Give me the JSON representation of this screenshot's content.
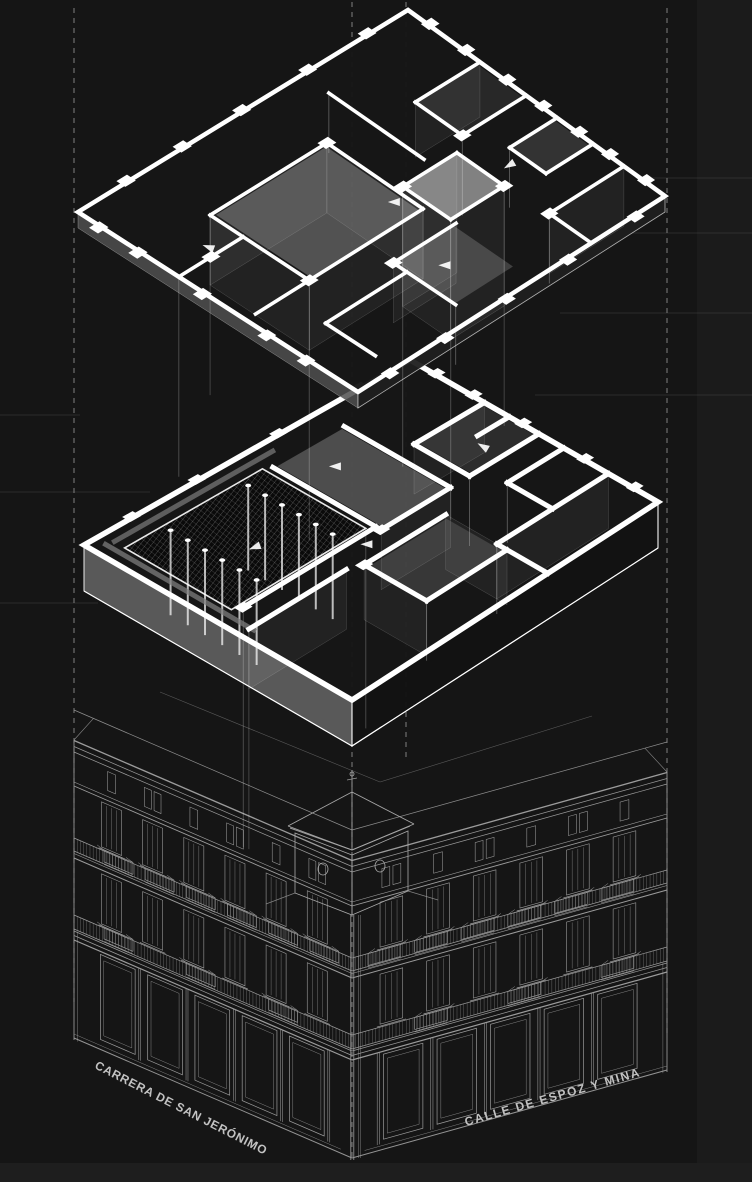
{
  "diagram": {
    "kind": "exploded-axonometric-architecture-drawing",
    "labels": {
      "street_left": "CARRERA DE SAN JERÓNIMO",
      "street_right": "CALLE DE ESPOZ Y MINA"
    },
    "colors": {
      "background": "#151515",
      "edge_strip": "#1e1e1e",
      "right_strip": "#1b1b1b",
      "plan_line": "#ffffff",
      "building_line": "#9b9b9b",
      "guide_line": "#9a9a9a",
      "faint_line": "#646464",
      "label_text": "#c2c2c2",
      "courtyard_fill": "#0a0a0a",
      "slab_side_gray": "#5f5f5f"
    }
  }
}
